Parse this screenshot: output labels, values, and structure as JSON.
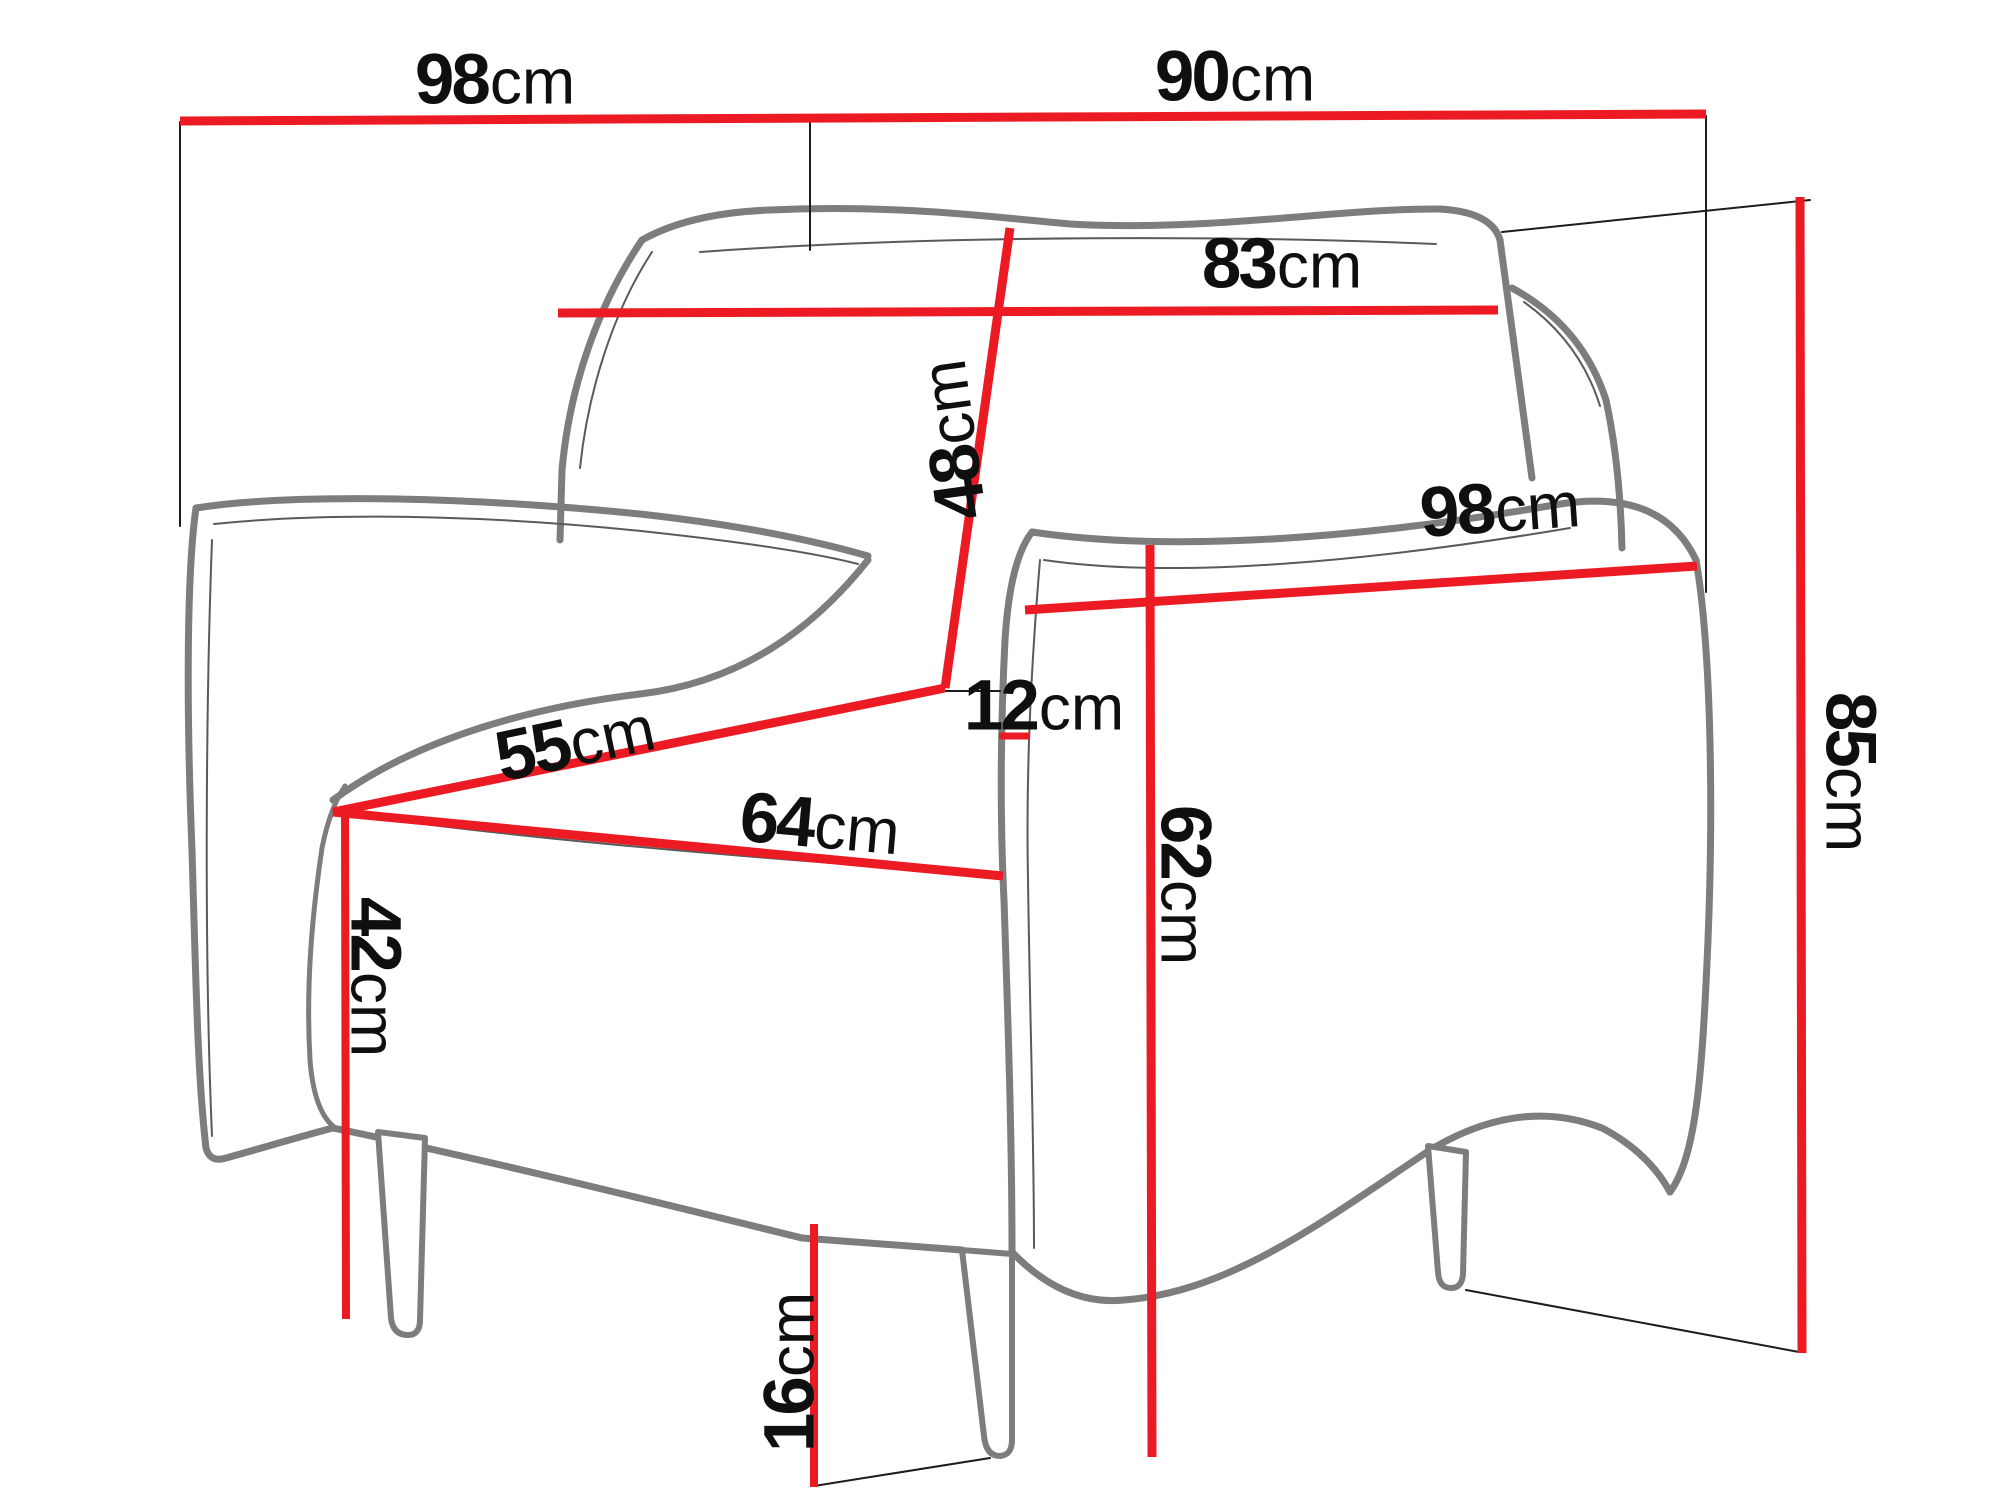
{
  "diagram": {
    "type": "furniture-dimension-diagram",
    "subject": "armchair",
    "view": "three-quarter front-left outline drawing",
    "unit": "cm"
  },
  "colors": {
    "dimension_red": "#ec1b23",
    "outline_gray": "#7d7d7d",
    "seam_gray": "#5a5a5a",
    "helper_black": "#1c1c1c",
    "text_black": "#0f0f0f",
    "background": "#ffffff"
  },
  "dimensions": {
    "back_width_top": {
      "value": "98",
      "unit": "cm"
    },
    "front_width_top": {
      "value": "90",
      "unit": "cm"
    },
    "backrest_width": {
      "value": "83",
      "unit": "cm"
    },
    "backrest_height": {
      "value": "48",
      "unit": "cm"
    },
    "side_depth": {
      "value": "98",
      "unit": "cm"
    },
    "seat_depth": {
      "value": "55",
      "unit": "cm"
    },
    "armrest_width": {
      "value": "12",
      "unit": "cm"
    },
    "seat_width": {
      "value": "64",
      "unit": "cm"
    },
    "armrest_height": {
      "value": "62",
      "unit": "cm"
    },
    "seat_height": {
      "value": "42",
      "unit": "cm"
    },
    "total_height": {
      "value": "85",
      "unit": "cm"
    },
    "leg_height": {
      "value": "16",
      "unit": "cm"
    }
  }
}
